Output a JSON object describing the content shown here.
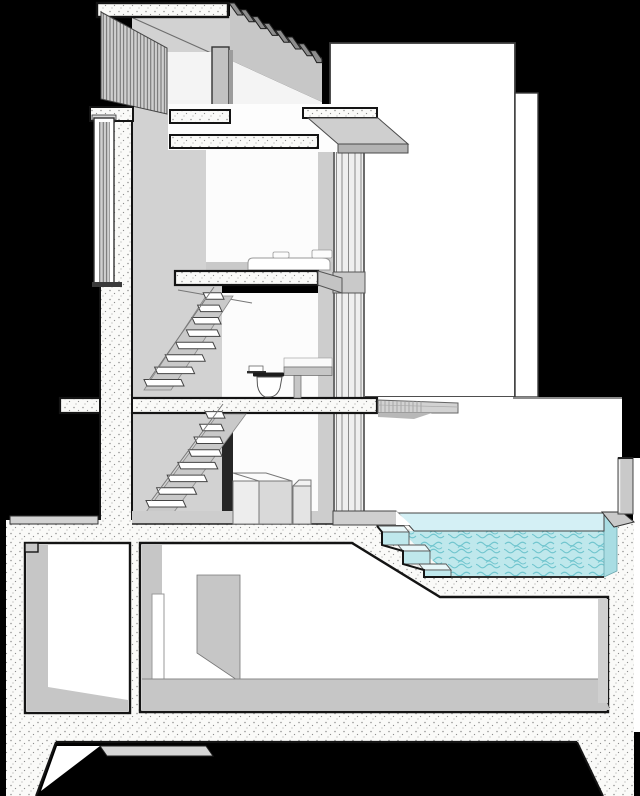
{
  "meta": {
    "type": "architectural-sectional-perspective",
    "description": "Black-background sectional perspective drawing of a narrow multi-storey house: stippled concrete cut surfaces, rooftop sun louvres, vertical slat screens on the left facade, an open stair with two flights, a bedroom with bed, a bathroom with toilet, a ground floor with island furniture, a basement with lightwell and storage room, and an elevated swimming pool with submerged steps on the right."
  },
  "palette": {
    "background": "#000000",
    "backdrop_white": "#ffffff",
    "room_white": "#fcfcfc",
    "concrete_base": "#fafaf8",
    "concrete_speckle": "#8f8f8f",
    "outline_dark": "#141414",
    "wall_gray": "#d2d2d2",
    "ceiling_gray": "#c7c7c7",
    "column_gray": "#c2c2c2",
    "floor_gray": "#c9c9c9",
    "glass_gray": "#efefef",
    "louver_base": "#cfcfcf",
    "louver_line": "#555555",
    "water_surface": "#d4f0f5",
    "water_body": "#bfe8ec",
    "water_texture": "#72c6cf",
    "water_edge": "#a9dde3",
    "deck_gray": "#cfcfcf",
    "dark_opening": "#262626"
  },
  "scene": {
    "roof": {
      "louver_fin_count": 8,
      "roof_slab": "stippled concrete",
      "slat_screen": "vertical louvres"
    },
    "stairs": {
      "flights": 2,
      "treads_per_flight": 8
    },
    "bedroom": {
      "furniture": [
        "bed platform",
        "cushions"
      ]
    },
    "bathroom": {
      "fixtures": [
        "toilet",
        "vanity shelf"
      ]
    },
    "ground_floor": {
      "furniture": [
        "island block",
        "stool block"
      ]
    },
    "pool": {
      "submerged_steps": 3,
      "water_level_y": 513,
      "texture": "squiggle ripple"
    },
    "basement": {
      "rooms": [
        "lightwell",
        "storage room"
      ],
      "partition_walls": 1,
      "door_count": 1
    },
    "backdrop": {
      "neighbour_planes": 2,
      "parapet": "gray",
      "courtyard": "white"
    }
  }
}
